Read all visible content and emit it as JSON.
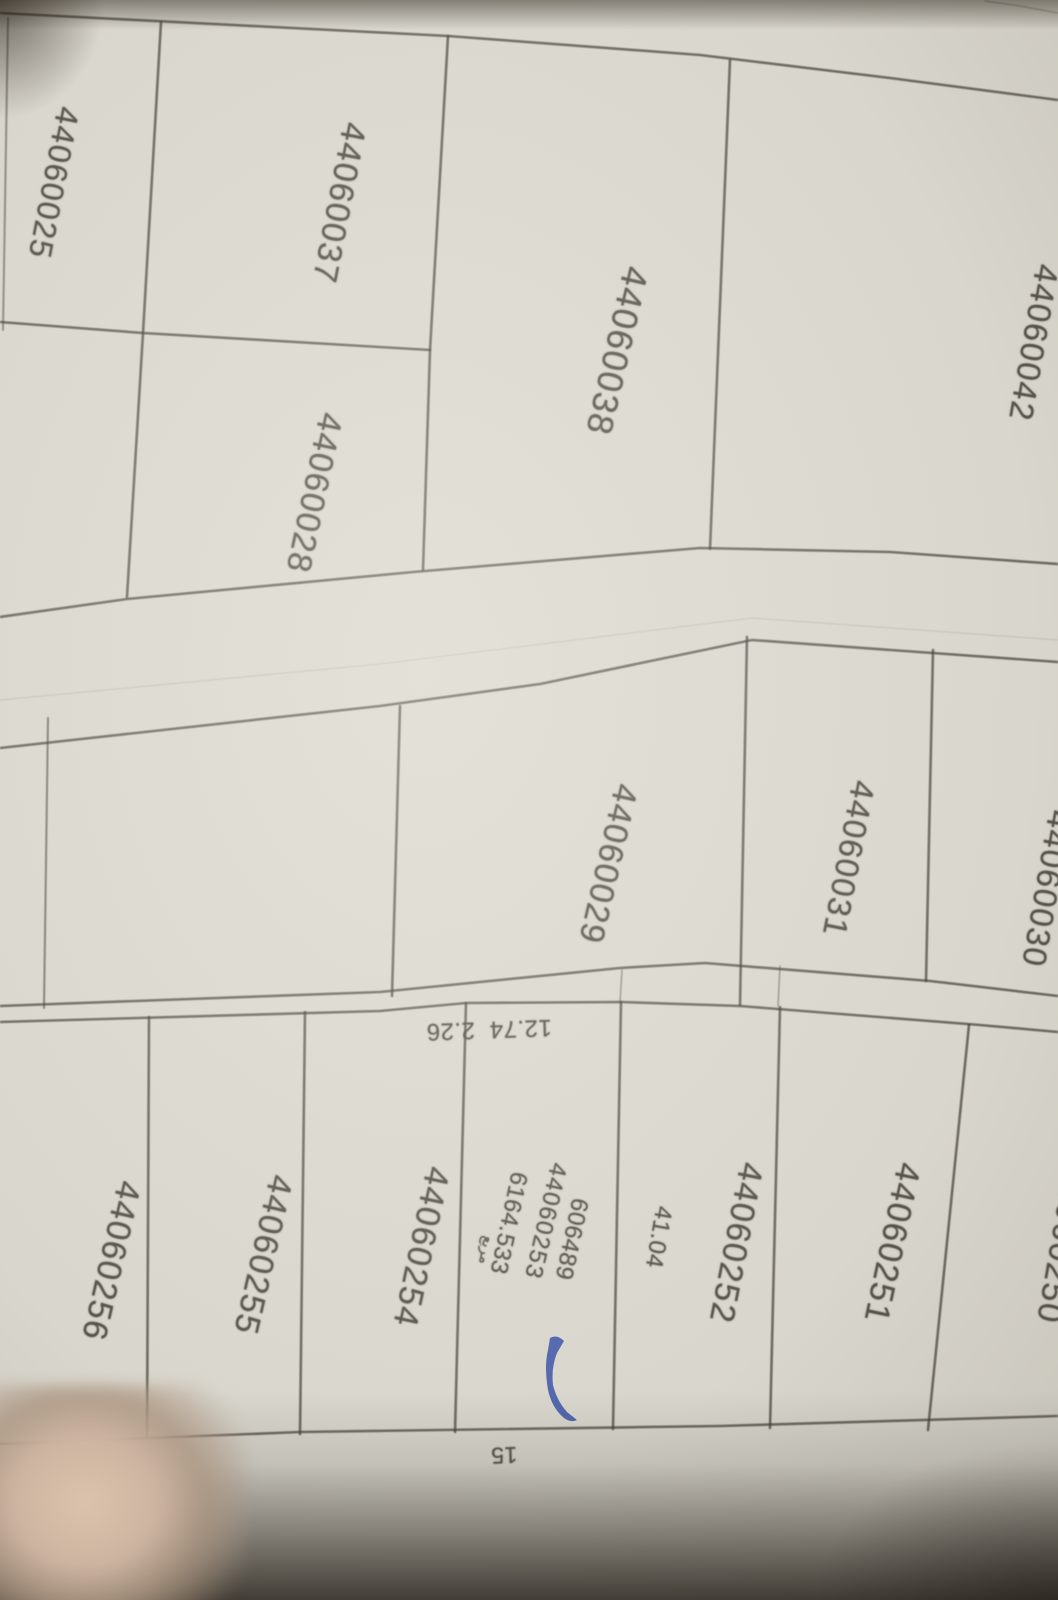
{
  "photo": {
    "description": "photographed cadastral parcel plan",
    "paper_color": "#d9d6cd",
    "line_color": "#454039",
    "ink_color": "#57524a",
    "pen_color": "#3c55a8"
  },
  "parcels": [
    {
      "name": "parcel-label-44060025",
      "label": "44060025",
      "x": 54,
      "y": 183,
      "rot": 101,
      "size": 32
    },
    {
      "name": "parcel-label-44060037",
      "label": "44060037",
      "x": 339,
      "y": 203,
      "rot": 101,
      "size": 34
    },
    {
      "name": "parcel-label-44060038",
      "label": "44060038",
      "x": 617,
      "y": 351,
      "rot": 103,
      "size": 36
    },
    {
      "name": "parcel-label-44060028",
      "label": "44060028",
      "x": 314,
      "y": 493,
      "rot": 102,
      "size": 34
    },
    {
      "name": "parcel-label-44060042",
      "label": "44060042",
      "x": 1034,
      "y": 343,
      "rot": 100,
      "size": 33
    },
    {
      "name": "parcel-label-44060029",
      "label": "44060029",
      "x": 608,
      "y": 864,
      "rot": 103,
      "size": 34
    },
    {
      "name": "parcel-label-44060031",
      "label": "44060031",
      "x": 849,
      "y": 859,
      "rot": 101,
      "size": 33
    },
    {
      "name": "parcel-label-44060030",
      "label": "44060030",
      "x": 1047,
      "y": 889,
      "rot": 100,
      "size": 33
    },
    {
      "name": "parcel-label-44060251",
      "label": "44060251",
      "x": 892,
      "y": 1243,
      "rot": 102,
      "size": 34
    },
    {
      "name": "parcel-label-44060252",
      "label": "44060252",
      "x": 736,
      "y": 1243,
      "rot": 101,
      "size": 34
    },
    {
      "name": "parcel-label-44060253",
      "label": "44060253",
      "x": 545,
      "y": 1221,
      "rot": 103,
      "size": 24
    },
    {
      "name": "parcel-label-44060254",
      "label": "44060254",
      "x": 421,
      "y": 1247,
      "rot": 102,
      "size": 34
    },
    {
      "name": "parcel-label-44060255",
      "label": "44060255",
      "x": 263,
      "y": 1255,
      "rot": 103,
      "size": 34
    },
    {
      "name": "parcel-label-44060256",
      "label": "44060256",
      "x": 111,
      "y": 1261,
      "rot": 103,
      "size": 34
    },
    {
      "name": "parcel-label-44060250",
      "label": "44060250",
      "x": 1062,
      "y": 1243,
      "rot": 100,
      "size": 34
    }
  ],
  "annotations": [
    {
      "name": "survey-number-606489",
      "text": "606489",
      "x": 571,
      "y": 1239,
      "rot": 102,
      "size": 24,
      "small": true
    },
    {
      "name": "area-value-6164-533",
      "text": "6164.533",
      "x": 508,
      "y": 1223,
      "rot": 102,
      "size": 24,
      "small": true
    },
    {
      "name": "arabic-note",
      "text": "مربع",
      "x": 486,
      "y": 1250,
      "rot": 100,
      "size": 15,
      "small": true,
      "arabic": true
    },
    {
      "name": "dimension-41-04",
      "text": "41.04",
      "x": 658,
      "y": 1237,
      "rot": 100,
      "size": 24,
      "small": true
    },
    {
      "name": "dimension-12-74-2-26",
      "text": "12.74  2.26",
      "x": 489,
      "y": 1029,
      "rot": 178,
      "size": 24,
      "small": true
    },
    {
      "name": "dimension-15",
      "text": "15",
      "x": 504,
      "y": 1455,
      "rot": 178,
      "size": 23,
      "small": true
    }
  ],
  "boundaries": [
    {
      "name": "top-boundary",
      "points": [
        [
          0,
          13
        ],
        [
          448,
          36
        ],
        [
          700,
          55
        ],
        [
          890,
          78
        ],
        [
          1058,
          100
        ]
      ]
    },
    {
      "name": "left-edge-boundary",
      "points": [
        [
          8,
          18
        ],
        [
          3,
          330
        ]
      ],
      "w": 2,
      "o": 0.5
    },
    {
      "name": "divider-25-37",
      "points": [
        [
          161,
          22
        ],
        [
          143,
          333
        ],
        [
          127,
          597
        ]
      ]
    },
    {
      "name": "parcel-25-28-bottom",
      "points": [
        [
          0,
          322
        ],
        [
          143,
          333
        ],
        [
          430,
          350
        ]
      ]
    },
    {
      "name": "divider-37-38",
      "points": [
        [
          448,
          36
        ],
        [
          430,
          350
        ],
        [
          423,
          570
        ]
      ]
    },
    {
      "name": "divider-38-42",
      "points": [
        [
          730,
          60
        ],
        [
          710,
          549
        ]
      ]
    },
    {
      "name": "road1-top-edge",
      "points": [
        [
          0,
          617
        ],
        [
          127,
          599
        ],
        [
          413,
          572
        ],
        [
          700,
          548
        ],
        [
          890,
          552
        ],
        [
          1058,
          564
        ]
      ]
    },
    {
      "name": "road1-crease",
      "points": [
        [
          0,
          700
        ],
        [
          380,
          664
        ],
        [
          752,
          618
        ],
        [
          1058,
          640
        ]
      ],
      "w": 1.3,
      "o": 0.12
    },
    {
      "name": "road1-bottom-edge",
      "points": [
        [
          0,
          748
        ],
        [
          380,
          706
        ],
        [
          540,
          684
        ],
        [
          752,
          640
        ],
        [
          1058,
          662
        ]
      ]
    },
    {
      "name": "divider-middle-left-sliver",
      "points": [
        [
          48,
          718
        ],
        [
          44,
          1008
        ]
      ],
      "w": 2,
      "o": 0.6
    },
    {
      "name": "divider-29-left",
      "points": [
        [
          400,
          706
        ],
        [
          392,
          996
        ]
      ]
    },
    {
      "name": "divider-29-31",
      "points": [
        [
          747,
          637
        ],
        [
          740,
          1005
        ]
      ]
    },
    {
      "name": "divider-31-30",
      "points": [
        [
          933,
          650
        ],
        [
          926,
          981
        ]
      ]
    },
    {
      "name": "road2-top-edge",
      "points": [
        [
          0,
          1006
        ],
        [
          380,
          992
        ],
        [
          620,
          968
        ],
        [
          705,
          963
        ],
        [
          930,
          981
        ],
        [
          1058,
          996
        ]
      ]
    },
    {
      "name": "road2-bottom-edge",
      "points": [
        [
          0,
          1022
        ],
        [
          380,
          1011
        ],
        [
          466,
          1003
        ],
        [
          621,
          1002
        ],
        [
          740,
          1006
        ],
        [
          980,
          1025
        ],
        [
          1058,
          1032
        ]
      ]
    },
    {
      "name": "road2-tick-1",
      "points": [
        [
          622,
          970
        ],
        [
          620,
          1002
        ]
      ],
      "w": 1.5,
      "o": 0.45
    },
    {
      "name": "road2-tick-2",
      "points": [
        [
          780,
          966
        ],
        [
          778,
          1006
        ]
      ],
      "w": 1.5,
      "o": 0.45
    },
    {
      "name": "divider-256-255",
      "points": [
        [
          149,
          1017
        ],
        [
          147,
          1437
        ]
      ]
    },
    {
      "name": "divider-255-254",
      "points": [
        [
          305,
          1012
        ],
        [
          300,
          1434
        ]
      ]
    },
    {
      "name": "divider-254-253",
      "points": [
        [
          466,
          1003
        ],
        [
          455,
          1432
        ]
      ]
    },
    {
      "name": "divider-253-252",
      "points": [
        [
          621,
          1002
        ],
        [
          613,
          1429
        ]
      ]
    },
    {
      "name": "divider-252-251",
      "points": [
        [
          780,
          1007
        ],
        [
          770,
          1428
        ]
      ]
    },
    {
      "name": "divider-251-250",
      "points": [
        [
          969,
          1025
        ],
        [
          928,
          1430
        ]
      ]
    },
    {
      "name": "bottom-row-boundary",
      "points": [
        [
          0,
          1444
        ],
        [
          300,
          1432
        ],
        [
          720,
          1426
        ],
        [
          1058,
          1416
        ]
      ]
    },
    {
      "name": "top-right-corner-line",
      "points": [
        [
          985,
          1
        ],
        [
          1020,
          6
        ],
        [
          1058,
          13
        ]
      ],
      "w": 1.5,
      "o": 0.3
    }
  ],
  "pen_mark": {
    "name": "blue-pen-mark",
    "path": "M550,1338 Q557,1334 564,1341 L557,1353 Q551,1368 553,1385 Q557,1401 567,1412 L577,1420 Q571,1423 564,1418 Q552,1408 548,1390 Q544,1366 548,1350 Z",
    "color": "#3c55a8"
  }
}
